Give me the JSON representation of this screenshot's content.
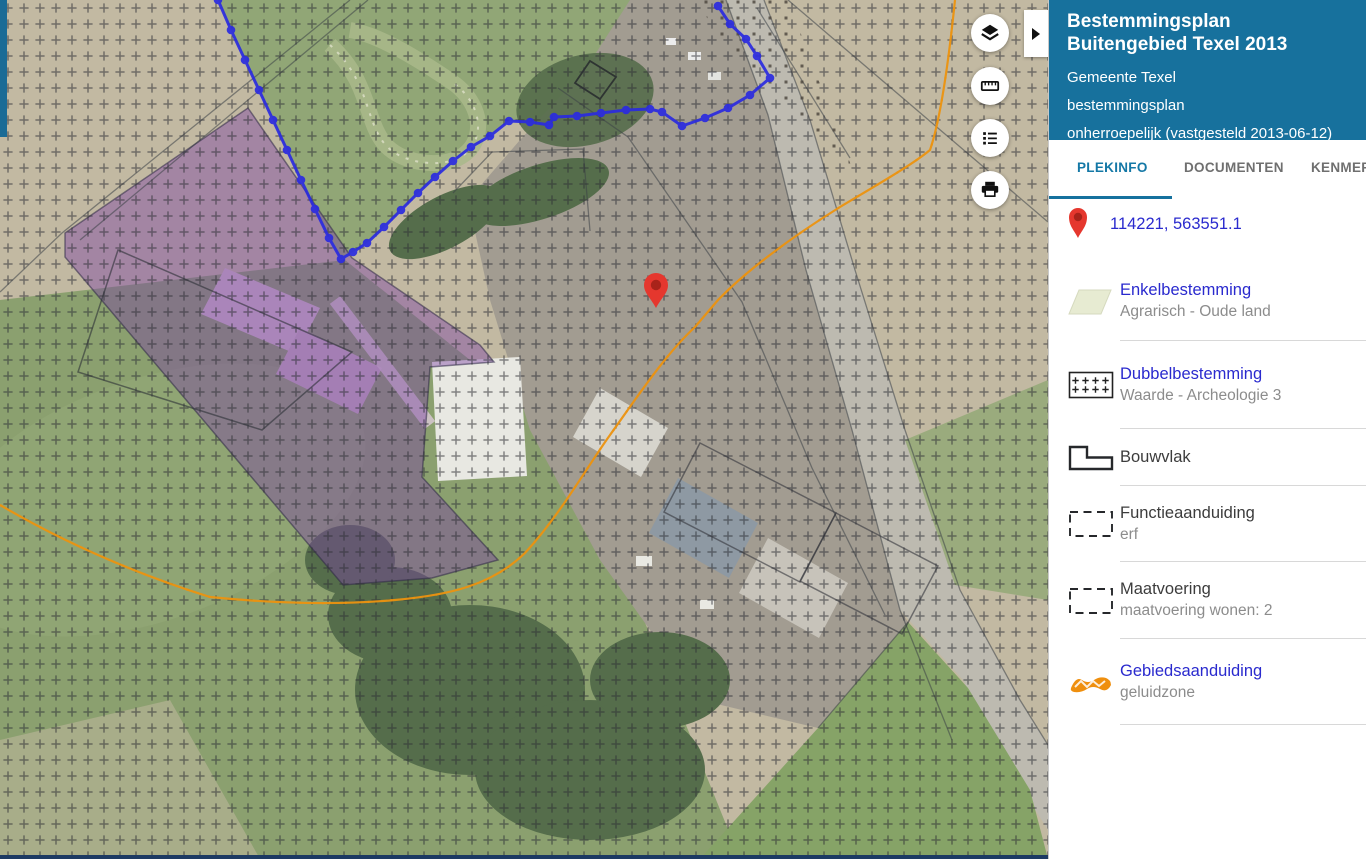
{
  "panel": {
    "header": {
      "title": "Bestemmingsplan Buitengebied Texel 2013",
      "subtitle_gemeente": "Gemeente Texel",
      "subtitle_plantype": "bestemmingsplan",
      "subtitle_status": "onherroepelijk (vastgesteld 2013-06-12)"
    },
    "tabs": [
      {
        "label": "PLEKINFO",
        "active": true
      },
      {
        "label": "DOCUMENTEN",
        "active": false
      },
      {
        "label": "KENMERKEN",
        "active": false
      }
    ],
    "coordinates": "114221, 563551.1",
    "items": [
      {
        "title": "Enkelbestemming",
        "subtitle": "Agrarisch - Oude land",
        "link": true,
        "icon": "parallelogram-swatch-icon",
        "height": 79
      },
      {
        "title": "Dubbelbestemming",
        "subtitle": "Waarde - Archeologie 3",
        "link": true,
        "icon": "plus-hatch-swatch-icon",
        "height": 88
      },
      {
        "title": "Bouwvlak",
        "subtitle": "",
        "link": false,
        "icon": "building-plot-outline-icon",
        "height": 57
      },
      {
        "title": "Functieaanduiding",
        "subtitle": "erf",
        "link": false,
        "icon": "dashed-rect-icon",
        "height": 76
      },
      {
        "title": "Maatvoering",
        "subtitle": "maatvoering wonen: 2",
        "link": false,
        "icon": "dashed-rect-icon",
        "height": 77
      },
      {
        "title": "Gebiedsaanduiding",
        "subtitle": "geluidzone",
        "link": true,
        "icon": "orange-zone-ribbon-icon",
        "height": 86
      }
    ]
  },
  "map": {
    "controls": [
      {
        "name": "layers",
        "icon": "layers-icon",
        "top": 14
      },
      {
        "name": "measure",
        "icon": "ruler-icon",
        "top": 67
      },
      {
        "name": "legend",
        "icon": "legend-list-icon",
        "top": 119
      },
      {
        "name": "print",
        "icon": "printer-icon",
        "top": 171
      }
    ],
    "collapse_arrow_icon": "chevron-right-icon",
    "marker_icon": "map-pin-icon"
  },
  "colors": {
    "header_bg": "#17719d",
    "active_tab": "#1478a6",
    "link_blue": "#2a2ace",
    "subtitle_gray": "#8c8c8c",
    "divider": "#d8d8d8",
    "marker_red": "#e5372e",
    "plan_boundary_blue": "#2b2be0",
    "noise_zone_orange": "#ec920f",
    "purple_zone": "#7a3ea5"
  }
}
